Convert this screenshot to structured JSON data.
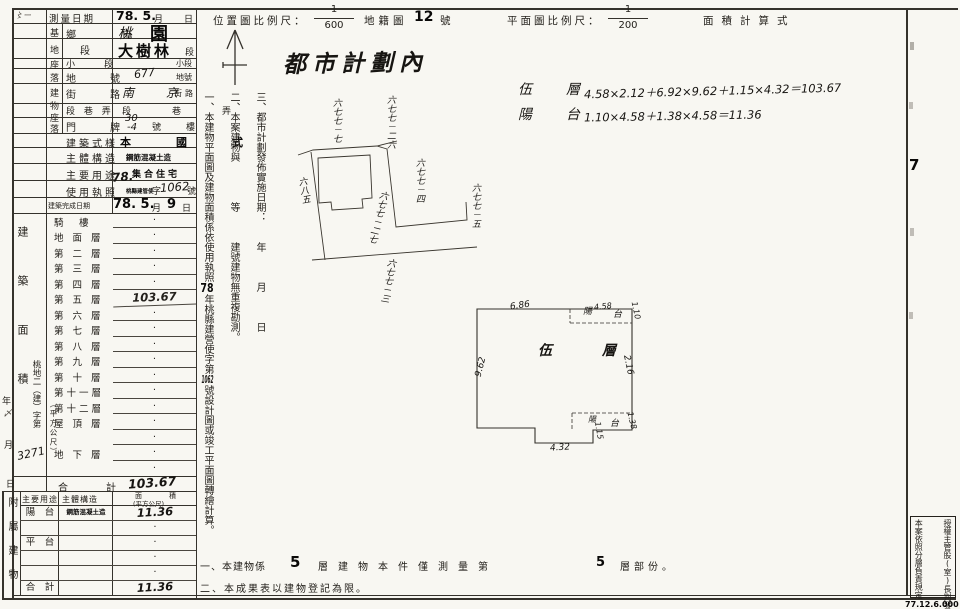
{
  "corner_mark": "〻ー",
  "city_plan": "都市計劃內",
  "header": {
    "survey_date_label": "測量日期",
    "survey_date_stamp": "78. 5.",
    "month": "月",
    "day": "日",
    "loc_scale_label": "位置圖比例尺：",
    "loc_num": "1",
    "loc_den": "600",
    "cad_label": "地籍圖",
    "cad_no": "12",
    "cad_suffix": "號",
    "plan_scale_label": "平面圖比例尺：",
    "plan_num": "1",
    "plan_den": "200",
    "area_label": "面積計算式"
  },
  "form": {
    "g1": [
      "基",
      "地",
      "座",
      "落"
    ],
    "g2": [
      "建",
      "物",
      "座",
      "落"
    ],
    "rows": {
      "xiang_label": "鄉　市",
      "xiang_hand": "桃",
      "xiang_stamp": "園",
      "duan_label": "段",
      "duan_stamp": "大樹林",
      "duan_suffix": "段",
      "xiaoduan_label": "小　段",
      "xiaoduan_suffix": "小段",
      "dihao_label": "地　號",
      "dihao_hand": "677",
      "dihao_suffix": "地號",
      "jielu_label": "街　路",
      "jielu_hand": "南 京",
      "jielu_suffix": "街路",
      "duanxiang_label": "段 巷 弄",
      "duanxiang_printed": "段　巷　弄",
      "menpai_label": "門　牌",
      "menpai_hand1": "30",
      "menpai_hand2": "-4",
      "menpai_hao": "號",
      "menpai_lou": "樓",
      "shiyang_label": "建築式樣",
      "shiyang_stamp": "本　國　式",
      "gouzao_label": "主體構造",
      "gouzao_stamp": "鋼筋混凝土造",
      "yongtu_label": "主要用途",
      "yongtu_stamp": "集合住宅",
      "zhizhao_label": "使用執照",
      "zhizhao_hand_year": "78.",
      "zhizhao_stamp": "桃縣建管使",
      "zhizhao_zi": "字",
      "zhizhao_no": "1062",
      "zhizhao_hao": "號",
      "wancheng_label": "建築完成日期",
      "wancheng_stamp1": "78. 5.",
      "wancheng_month": "月",
      "wancheng_stamp2": "9",
      "wancheng_day": "日"
    }
  },
  "floors": {
    "section_label": "建築面積",
    "unit": "（平方公尺）",
    "rows": [
      {
        "label": "騎　樓",
        "value": "·"
      },
      {
        "label": "地 面 層",
        "value": "·"
      },
      {
        "label": "第 二 層",
        "value": "·"
      },
      {
        "label": "第 三 層",
        "value": "·"
      },
      {
        "label": "第 四 層",
        "value": "·"
      },
      {
        "label": "第 五 層",
        "value": "103.67"
      },
      {
        "label": "第 六 層",
        "value": "·"
      },
      {
        "label": "第 七 層",
        "value": "·"
      },
      {
        "label": "第 八 層",
        "value": "·"
      },
      {
        "label": "第 九 層",
        "value": "·"
      },
      {
        "label": "第 十 層",
        "value": "·"
      },
      {
        "label": "第十一層",
        "value": "·"
      },
      {
        "label": "第十二層",
        "value": "·"
      },
      {
        "label": "屋 頂 層",
        "value": "·"
      },
      {
        "label": "",
        "value": "·"
      },
      {
        "label": "地 下 層",
        "value": "·"
      },
      {
        "label": "",
        "value": "·"
      }
    ],
    "total_label": "合　計",
    "total_value": "103.67"
  },
  "attached": {
    "section_label": "附屬建物",
    "h_use": "主要用途",
    "h_struct": "主體構造",
    "h_area": "面　積",
    "h_area_unit": "(平方公尺)",
    "rows": [
      {
        "use": "陽　台",
        "structure": "鋼筋混凝土造",
        "area": "11.36"
      },
      {
        "use": "",
        "structure": "",
        "area": "·"
      },
      {
        "use": "平　台",
        "structure": "",
        "area": "·"
      },
      {
        "use": "",
        "structure": "",
        "area": "·"
      },
      {
        "use": "",
        "structure": "",
        "area": "·"
      },
      {
        "use": "合　計",
        "structure": "",
        "area": "11.36"
      }
    ]
  },
  "margin": {
    "file_prefix": "桃地二（建）字第",
    "file_no": "3271",
    "year": "年",
    "month": "月",
    "day": "日",
    "squiggle": "〆"
  },
  "notes_vertical": {
    "n1a": "一、本建物平面圖及建物面積係依使用執照",
    "n1_year": "78",
    "n1b": "年桃縣建營使字第",
    "n1_no": "1062",
    "n1c": "號設計圖或竣工平面圖轉繪計算。",
    "n2": "二、本案建物與　　　　等　　　建號建物無重複勘測。",
    "n3": "三、都市計劃發佈實施日期：　　年　　　月　　　日"
  },
  "formulas": {
    "f1_label": "伍　層",
    "f1": "4.58×2.12＋6.92×9.62＋1.15×4.32＝103.67",
    "f2_label": "陽　台",
    "f2": "1.10×4.58＋1.38×4.58＝11.36"
  },
  "sketch": {
    "labels": {
      "l1": "六七七－七",
      "l2": "六七七－二六",
      "l3": "六七七－四",
      "l4": "六七七－五",
      "l5": "六七七－二七",
      "l6": "六八五",
      "l7": "六七七－三"
    }
  },
  "floorplan": {
    "room": "伍　層",
    "top": "6.86",
    "left": "9.62",
    "right": "2.16",
    "bal_top_1": "陽",
    "bal_top_w": "4.58",
    "bal_top_2": "台",
    "bal_top_d": "1.10",
    "bal_bot_1": "陽",
    "bal_bot_2": "台",
    "bal_bot_d": "1.38",
    "step": "1.15",
    "notch": "4.32"
  },
  "bottom_notes": {
    "n1a": "一、本建物係",
    "n1_f": "5",
    "n1b": "層建物本件僅測量第",
    "n1_p": "5",
    "n1c": "層部份。",
    "n2": "二、本成果表以建物登記為限。"
  },
  "right_margin": {
    "page": "7",
    "box_r": "授權主管股(室)長判發",
    "box_l": "本案依照分層負責規定",
    "code": "77.12.6.000"
  }
}
